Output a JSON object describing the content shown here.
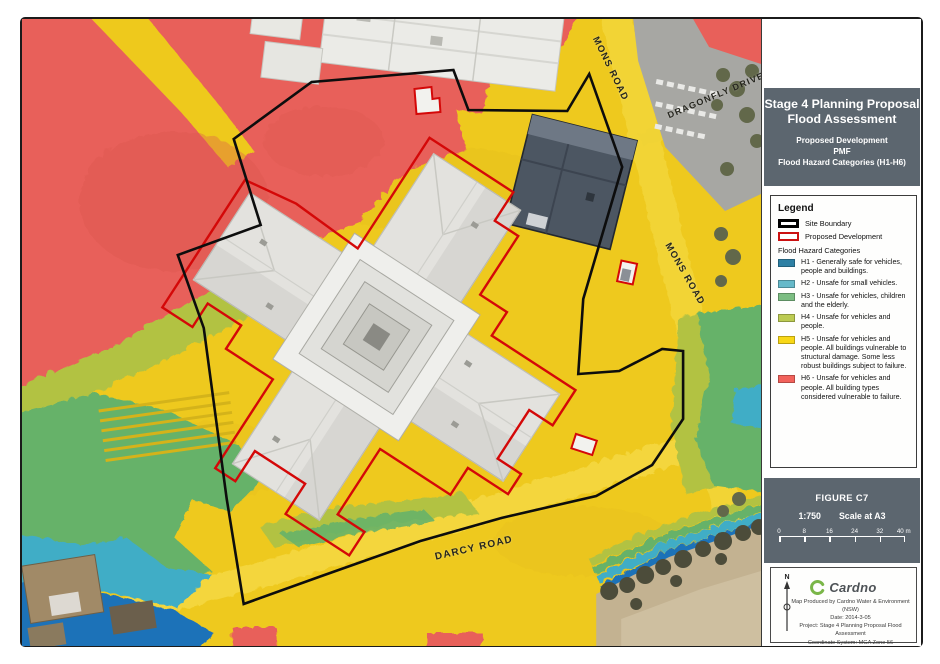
{
  "title_block": {
    "line1": "Stage 4 Planning Proposal",
    "line2": "Flood Assessment",
    "sub1": "Proposed Development",
    "sub2": "PMF",
    "sub3": "Flood Hazard Categories (H1-H6)"
  },
  "legend": {
    "heading": "Legend",
    "site_boundary_label": "Site Boundary",
    "site_boundary_color": "#000000",
    "proposed_development_label": "Proposed Development",
    "proposed_development_color": "#cb1111",
    "categories_heading": "Flood Hazard Categories",
    "categories": [
      {
        "code": "H1",
        "color": "#2e80a4",
        "text": "H1 - Generally safe for vehicles, people and buildings."
      },
      {
        "code": "H2",
        "color": "#66b9c9",
        "text": "H2 - Unsafe for small vehicles."
      },
      {
        "code": "H3",
        "color": "#7cbd82",
        "text": "H3 - Unsafe for vehicles, children and the elderly."
      },
      {
        "code": "H4",
        "color": "#bccb52",
        "text": "H4 - Unsafe for vehicles and people."
      },
      {
        "code": "H5",
        "color": "#f8d716",
        "text": "H5 - Unsafe for vehicles and people. All buildings vulnerable to structural damage. Some less robust buildings subject to failure."
      },
      {
        "code": "H6",
        "color": "#f2625b",
        "text": "H6 - Unsafe for vehicles and people. All building types considered vulnerable to failure."
      }
    ]
  },
  "figure_block": {
    "figure": "FIGURE C7",
    "scale_ratio": "1:750",
    "scale_note": "Scale at A3",
    "scale_ticks": [
      "0",
      "8",
      "16",
      "24",
      "32",
      "40 m"
    ]
  },
  "credits": {
    "north_label": "N",
    "brand": "Cardno",
    "lines": [
      "Map Produced by Cardno Water & Environment (NSW)",
      "Date: 2014-3-05",
      "Project: Stage 4 Planning Proposal Flood Assessment",
      "Coordinate System: MGA Zone 56"
    ]
  },
  "map": {
    "road_labels": [
      {
        "id": "mons-road-top",
        "text": "MONS ROAD"
      },
      {
        "id": "dragonfly-drive",
        "text": "DRAGONFLY DRIVE"
      },
      {
        "id": "mons-road-east",
        "text": "MONS ROAD"
      },
      {
        "id": "darcy-road",
        "text": "DARCY ROAD"
      }
    ],
    "overlay_colors": {
      "h1_blue": "#1d72b8",
      "h2_cyan": "#41adc6",
      "h3_green": "#66b269",
      "h4_olive": "#b2c243",
      "h5_yellow": "#eec91e",
      "h6_red": "#e8605a"
    }
  }
}
